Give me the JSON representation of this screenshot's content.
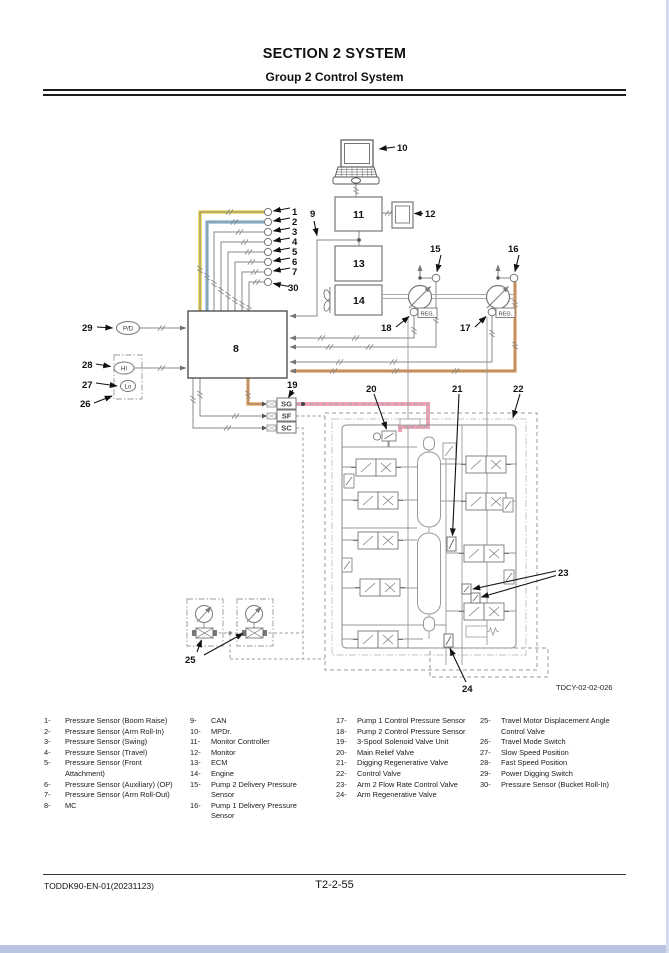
{
  "page": {
    "header": {
      "title": "SECTION 2 SYSTEM",
      "subtitle": "Group 2 Control System"
    },
    "footer": {
      "doc_code": "TODDK90-EN-01(20231123)",
      "page_number": "T2-2-55"
    },
    "figure_code": "TDCY-02-02-026"
  },
  "diagram": {
    "callouts": {
      "c1": "1",
      "c2": "2",
      "c3": "3",
      "c4": "4",
      "c5": "5",
      "c6": "6",
      "c7": "7",
      "c8": "8",
      "c9": "9",
      "c10": "10",
      "c11": "11",
      "c12": "12",
      "c13": "13",
      "c14": "14",
      "c15": "15",
      "c16": "16",
      "c17": "17",
      "c18": "18",
      "c19": "19",
      "c20": "20",
      "c21": "21",
      "c22": "22",
      "c23": "23",
      "c24": "24",
      "c25": "25",
      "c26": "26",
      "c27": "27",
      "c28": "28",
      "c29": "29",
      "c30": "30"
    },
    "ovals": {
      "pd": "P/D",
      "hi": "HI",
      "lo": "Lo"
    },
    "reg_label": "REG.",
    "connectors": {
      "sg": "SG",
      "sf": "SF",
      "sc": "SC"
    },
    "highlight_colors": {
      "yellow": "#e8d44c",
      "blue": "#8fc0de",
      "orange": "#e89a4d",
      "pink": "#f2a3b8",
      "wire_gray": "#8a8a8a"
    }
  },
  "legend": {
    "columns": [
      {
        "items": [
          {
            "n": "1-",
            "text": "Pressure Sensor (Boom Raise)"
          },
          {
            "n": "2-",
            "text": "Pressure Sensor (Arm Roll-In)"
          },
          {
            "n": "3-",
            "text": "Pressure Sensor (Swing)"
          },
          {
            "n": "4-",
            "text": "Pressure Sensor (Travel)"
          },
          {
            "n": "5-",
            "text": "Pressure Sensor (Front Attachment)"
          },
          {
            "n": "6-",
            "text": "Pressure Sensor (Auxiliary) (OP)"
          },
          {
            "n": "7-",
            "text": "Pressure Sensor (Arm Roll-Out)"
          },
          {
            "n": "8-",
            "text": "MC"
          }
        ]
      },
      {
        "items": [
          {
            "n": "9-",
            "text": "CAN"
          },
          {
            "n": "10-",
            "text": "MPDr."
          },
          {
            "n": "11-",
            "text": "Monitor Controller"
          },
          {
            "n": "12-",
            "text": "Monitor"
          },
          {
            "n": "13-",
            "text": "ECM"
          },
          {
            "n": "14-",
            "text": "Engine"
          },
          {
            "n": "15-",
            "text": "Pump 2 Delivery Pressure Sensor"
          },
          {
            "n": "16-",
            "text": "Pump 1 Delivery Pressure Sensor"
          }
        ]
      },
      {
        "items": [
          {
            "n": "17-",
            "text": "Pump 1 Control Pressure Sensor"
          },
          {
            "n": "18-",
            "text": "Pump 2 Control Pressure Sensor"
          },
          {
            "n": "19-",
            "text": "3-Spool Solenoid Valve Unit"
          },
          {
            "n": "20-",
            "text": "Main Relief Valve"
          },
          {
            "n": "21-",
            "text": "Digging Regenerative Valve"
          },
          {
            "n": "22-",
            "text": "Control Valve"
          },
          {
            "n": "23-",
            "text": "Arm 2 Flow Rate Control Valve"
          },
          {
            "n": "24-",
            "text": "Arm Regenerative Valve"
          }
        ]
      },
      {
        "items": [
          {
            "n": "25-",
            "text": "Travel Motor Displacement Angle Control Valve"
          },
          {
            "n": "26-",
            "text": "Travel Mode Switch"
          },
          {
            "n": "27-",
            "text": "Slow Speed Position"
          },
          {
            "n": "28-",
            "text": "Fast Speed Position"
          },
          {
            "n": "29-",
            "text": "Power Digging Switch"
          },
          {
            "n": "30-",
            "text": "Pressure Sensor (Bucket Roll-In)"
          }
        ]
      }
    ]
  }
}
